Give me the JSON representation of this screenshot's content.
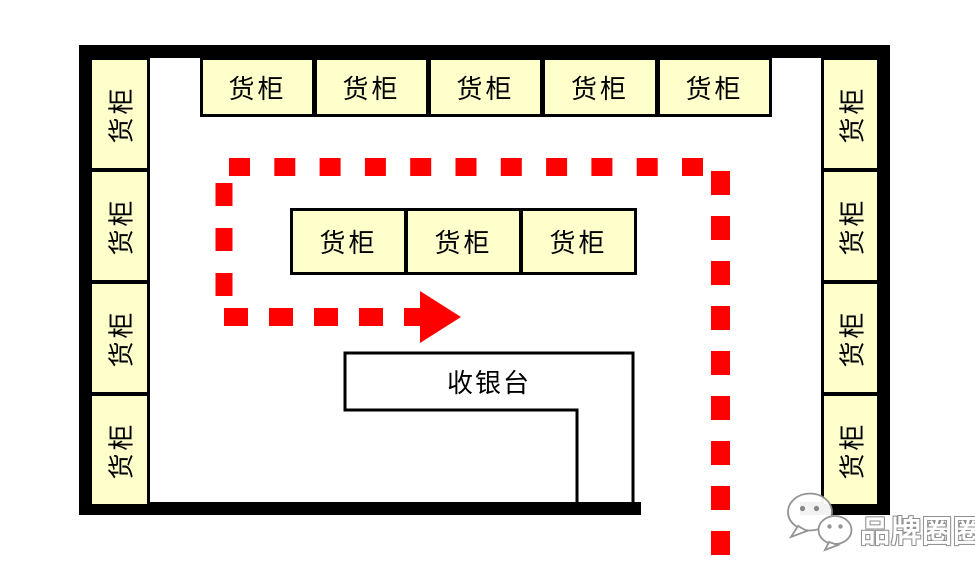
{
  "diagram": {
    "cashier_label": "收银台",
    "shelves": {
      "top": [
        "货柜",
        "货柜",
        "货柜",
        "货柜",
        "货柜"
      ],
      "middle": [
        "货柜",
        "货柜",
        "货柜"
      ],
      "left": [
        "货柜",
        "货柜",
        "货柜",
        "货柜"
      ],
      "right": [
        "货柜",
        "货柜",
        "货柜",
        "货柜"
      ]
    }
  },
  "watermark": {
    "text": "品牌圈圈",
    "icon": "wechat-logo"
  },
  "colors": {
    "shelf_fill": "#FFFFCC",
    "outline": "#000000",
    "wall": "#000000",
    "path_red": "#FF0000",
    "cashier_fill": "#FFFFFF",
    "watermark_stroke": "#8F8F8F",
    "watermark_fill": "#FFFFFF"
  }
}
